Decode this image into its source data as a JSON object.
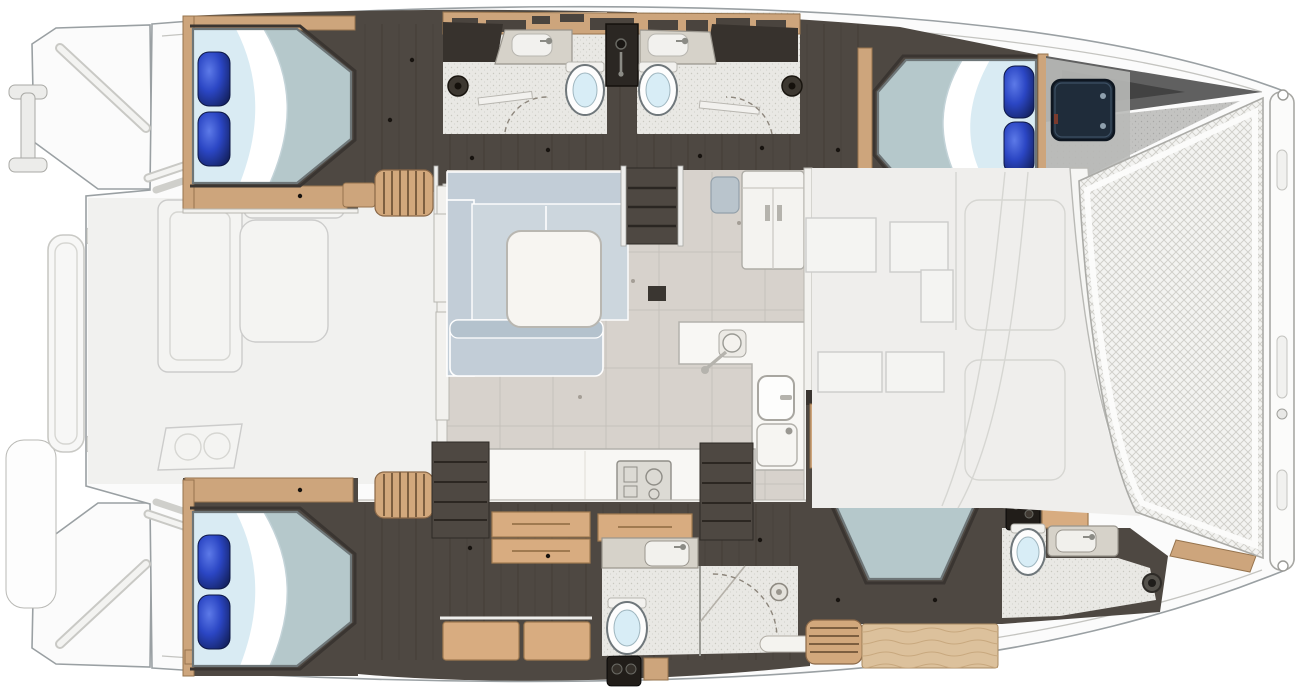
{
  "diagram": {
    "label": "Catamaran yacht interior layout floor plan, plan view with bow to the right",
    "type": "catamaran-floor-plan",
    "orientation": {
      "bow": "right",
      "stern": "left"
    },
    "areas": [
      {
        "id": "aft-cockpit",
        "name": "Aft cockpit with bench seat and table"
      },
      {
        "id": "port-aft-cabin",
        "name": "Port aft double cabin"
      },
      {
        "id": "port-heads",
        "name": "Port twin bathrooms with central shower column"
      },
      {
        "id": "port-fwd-cabin",
        "name": "Port forward double cabin with hull window"
      },
      {
        "id": "salon",
        "name": "Main-deck salon with L-sofa, coffee table and L-shaped galley"
      },
      {
        "id": "stbd-aft-cabin",
        "name": "Starboard aft double cabin"
      },
      {
        "id": "stbd-head",
        "name": "Starboard mid bathroom with shower"
      },
      {
        "id": "stbd-fwd-cabin",
        "name": "Starboard forward double cabin"
      },
      {
        "id": "stbd-fwd-head",
        "name": "Starboard forward bathroom"
      },
      {
        "id": "foredeck",
        "name": "Foredeck with bow trampoline and crossbeam"
      }
    ],
    "fixtures": {
      "double_beds": 4,
      "toilets": 4,
      "sinks": 6,
      "staircases": 4,
      "sofas": 1,
      "tables": 2,
      "stoves": 1,
      "trampolines": 1,
      "boarding_ladders": 1
    }
  },
  "colors": {
    "hullOutline": "#9aa0a3",
    "deckWhite": "#fbfbfb",
    "exteriorFaded": "#efeeec",
    "darkFloor": "#4e4842",
    "plankLine": "#433d37",
    "woodTrim": "#cda57c",
    "woodLight": "#dcc19c",
    "mattress": "#b5c8cb",
    "mattressHead": "#d9ebf3",
    "sheet": "#ffffff",
    "pillowBlue": "#2b46c4",
    "pillowBlueDark": "#101c52",
    "sofa": "#c2cdd7",
    "salonFloor": "#d7d2cc",
    "counterWhite": "#f8f7f4",
    "counterGrey": "#d6d2c9",
    "speckleFloor": "#e9e8e4",
    "toiletLid": "#d8edf6",
    "windowDark": "#1f2c3a",
    "meshFill": "#f3f3f1",
    "meshLine": "#cfcec9"
  }
}
